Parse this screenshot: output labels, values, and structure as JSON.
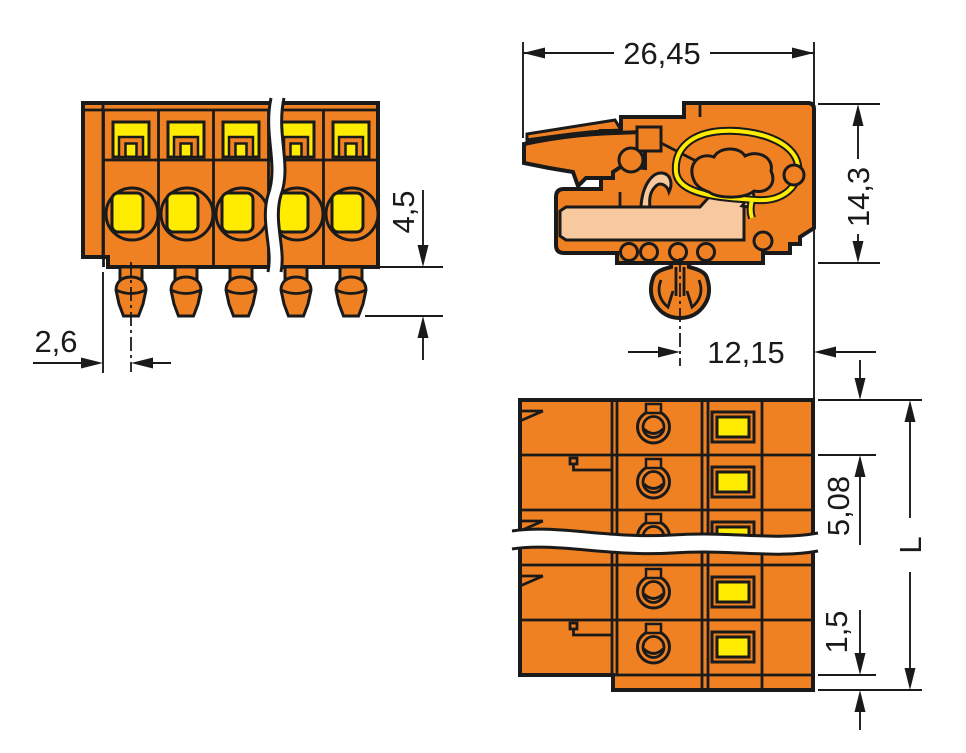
{
  "drawing": {
    "colors": {
      "body_orange": "#F08122",
      "accent_yellow": "#FFEC00",
      "contact_peach": "#F8C99E",
      "outline_black": "#1A1A1A",
      "dimension_gray": "#1A1A1A"
    },
    "dims": {
      "pin_offset": "2,6",
      "pin_projection": "4,5",
      "total_width": "26,45",
      "height": "14,3",
      "foot_offset": "12,15",
      "pitch": "5,08",
      "end_offset": "1,5",
      "total_length": "L"
    }
  }
}
